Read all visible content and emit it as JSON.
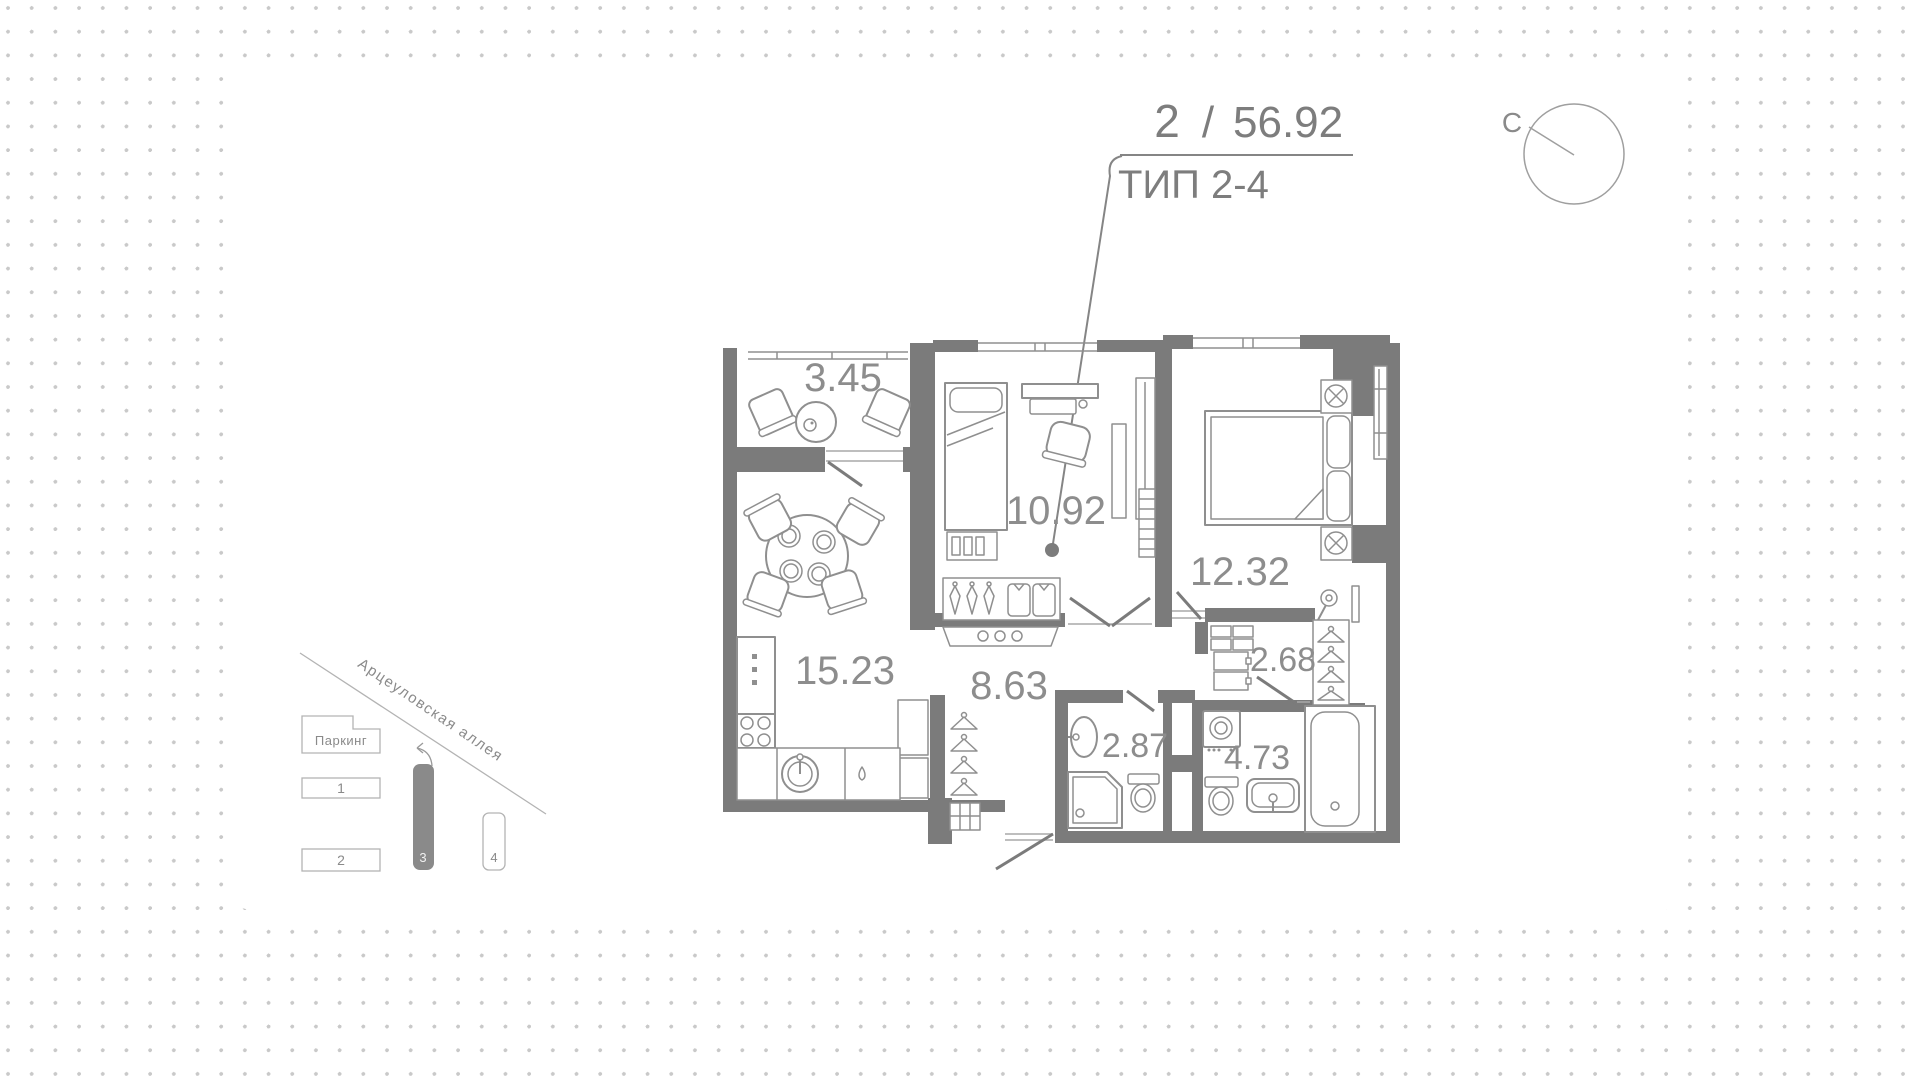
{
  "header": {
    "rooms_count": "2",
    "separator": "/",
    "total_area": "56.92",
    "type_label": "ТИП 2-4"
  },
  "compass": {
    "north_label": "С"
  },
  "plan": {
    "rooms": [
      {
        "name": "balcony",
        "area": "3.45"
      },
      {
        "name": "bedroom-1",
        "area": "10.92"
      },
      {
        "name": "bedroom-2",
        "area": "12.32"
      },
      {
        "name": "kitchen-living",
        "area": "15.23"
      },
      {
        "name": "hallway",
        "area": "8.63"
      },
      {
        "name": "wardrobe",
        "area": "2.68"
      },
      {
        "name": "shower-room",
        "area": "2.87"
      },
      {
        "name": "bathroom",
        "area": "4.73"
      }
    ]
  },
  "minimap": {
    "street": "Арцеуловская аллея",
    "parking_label": "Паркинг",
    "buildings": [
      {
        "label": "1",
        "active": false
      },
      {
        "label": "2",
        "active": false
      },
      {
        "label": "3",
        "active": true
      },
      {
        "label": "4",
        "active": false
      }
    ]
  },
  "colors": {
    "wall": "#7b7b7b",
    "furniture": "#8f8f8f",
    "label": "#8d8d8d",
    "dot": "#c9c9c9",
    "active_building": "#8a8a8a"
  }
}
